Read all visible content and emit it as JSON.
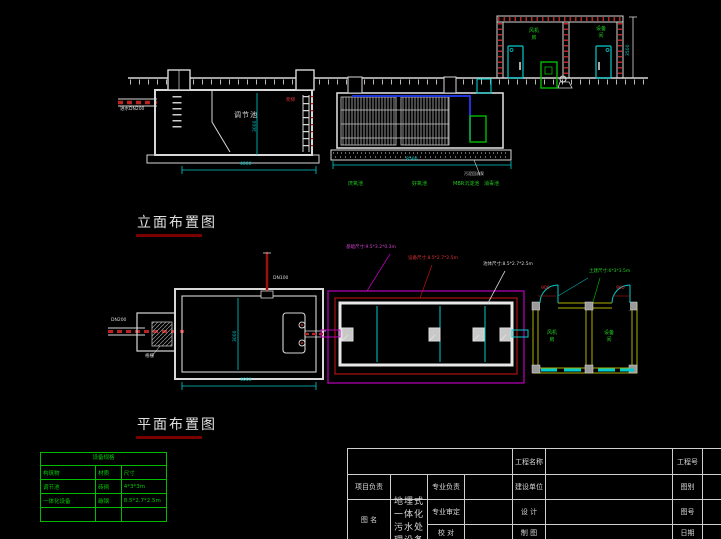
{
  "headings": {
    "elevation": "立面布置图",
    "plan": "平面布置图"
  },
  "elevation": {
    "inlet_label": "进水DN200",
    "tank_label": "调节池",
    "ladder_label": "爬梯",
    "dim_width": "4000",
    "dim_height": "3000",
    "equip_dim_width": "8500",
    "sludge_pump_note": "污泥回流泵",
    "compartments": [
      "厌氧池",
      "好氧池",
      "MBR沉淀池",
      "消毒池"
    ],
    "building": {
      "room_left": "风机房",
      "room_right": "设备间",
      "dim_height": "3500"
    }
  },
  "plan": {
    "inlet_label": "DN200",
    "screen_label": "格栅",
    "vent_label": "DN100",
    "dim_width": "4000",
    "dim_height": "3000",
    "leader_foundation": "基础尺寸:9.5*3.2*0.3m",
    "leader_equipment": "设备尺寸:8.5*2.7*2.5m",
    "leader_tank": "池体尺寸:8.5*2.7*2.5m",
    "building": {
      "label": "土建尺寸:6*3*3.5m",
      "door_left": "900",
      "door_right": "900",
      "room_left": "风机房",
      "room_right": "设备间"
    }
  },
  "spec_table": {
    "title": "设备规格",
    "headers": [
      "构筑物",
      "材质",
      "尺寸"
    ],
    "rows": [
      [
        "调节池",
        "砖砌",
        "4*3*3m"
      ],
      [
        "一体化设备",
        "碳钢",
        "8.5*2.7*2.5m"
      ],
      [
        "",
        "",
        ""
      ]
    ]
  },
  "titleblock": {
    "project_name_label": "工程名称",
    "project_no_label": "工程号",
    "pm_label": "项目负责",
    "lead_label": "专业负责",
    "client_label": "建设单位",
    "category_label": "图别",
    "review_label": "专业审定",
    "design_label": "设 计",
    "dwgname_label": "图 名",
    "dwgno_label": "图号",
    "check_label": "校 对",
    "draft_label": "制 图",
    "date_label": "日期",
    "drawing_title": "地埋式一体化污水处理设备"
  }
}
